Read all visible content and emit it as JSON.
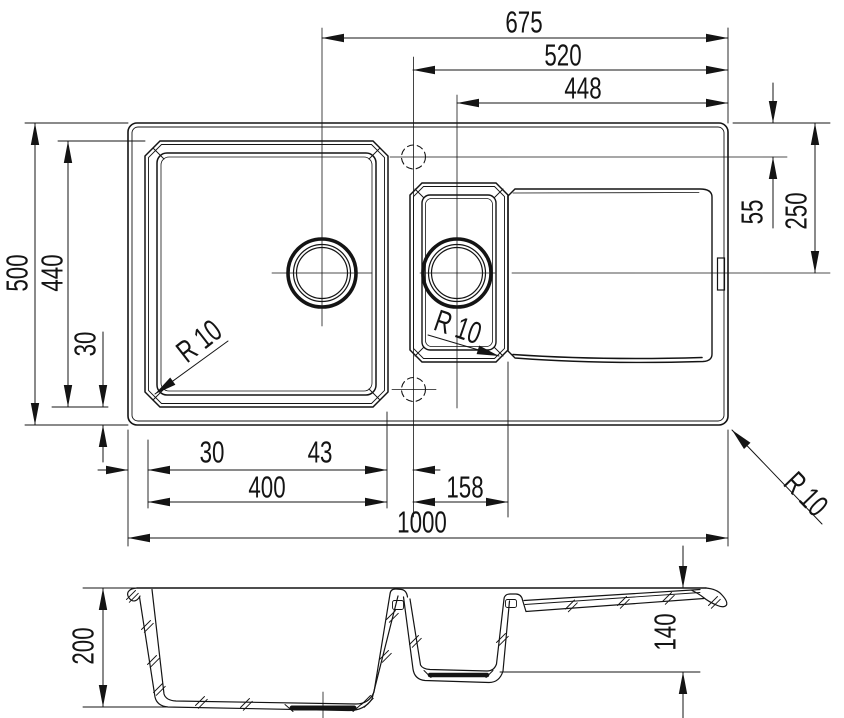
{
  "colors": {
    "line": "#141414",
    "background": "#ffffff"
  },
  "dimensions": {
    "d675": "675",
    "d520": "520",
    "d448": "448",
    "d500": "500",
    "d440": "440",
    "d30_left": "30",
    "d55": "55",
    "d250": "250",
    "d30_bottom": "30",
    "d43": "43",
    "d400": "400",
    "d158": "158",
    "d1000": "1000",
    "d200": "200",
    "d140": "140",
    "r10_main_bowl": "R 10",
    "r10_small_bowl": "R 10",
    "r10_sink_corner": "R 10"
  }
}
